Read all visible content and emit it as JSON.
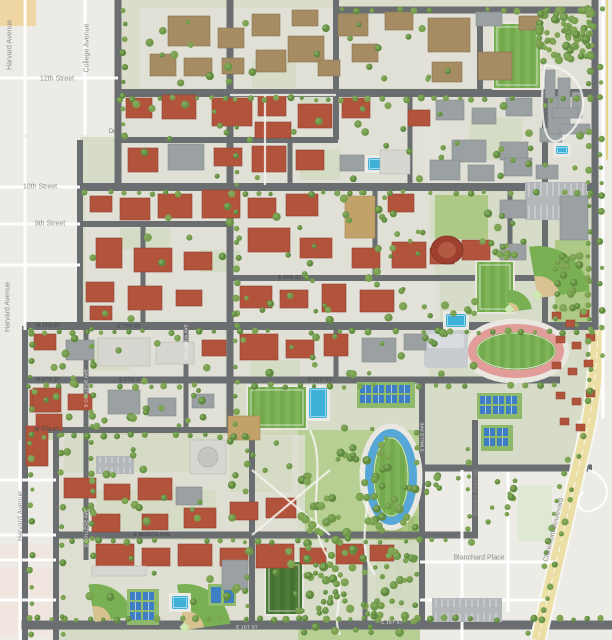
{
  "map": {
    "street_labels": [
      {
        "text": "Harvard Avenue",
        "x": 10,
        "y": 45,
        "rot": -90,
        "cls": "city"
      },
      {
        "text": "College Avenue",
        "x": 87,
        "y": 48,
        "rot": -90,
        "cls": "city"
      },
      {
        "text": "12th Street",
        "x": 57,
        "y": 79,
        "rot": 0,
        "cls": "city"
      },
      {
        "text": "10th Street",
        "x": 40,
        "y": 187,
        "rot": 0,
        "cls": "city"
      },
      {
        "text": "9th Street",
        "x": 50,
        "y": 224,
        "rot": 0,
        "cls": "city"
      },
      {
        "text": "Dr",
        "x": 112,
        "y": 132,
        "rot": 0,
        "cls": "drlbl"
      },
      {
        "text": "Harvard Avenue",
        "x": 8,
        "y": 307,
        "rot": -90,
        "cls": "city"
      },
      {
        "text": "Harvard Avenue",
        "x": 21,
        "y": 516,
        "rot": -90,
        "cls": "city"
      },
      {
        "text": "Brooks Avenue",
        "x": 476,
        "y": 493,
        "rot": -90,
        "cls": "city"
      },
      {
        "text": "Claremont Boulevard",
        "x": 554,
        "y": 530,
        "rot": -76,
        "cls": "city"
      },
      {
        "text": "Blanchard Place",
        "x": 479,
        "y": 558,
        "rot": 0,
        "cls": "city"
      },
      {
        "text": "E BONITA AVE",
        "x": 152,
        "y": 535,
        "rot": 0,
        "cls": "tiny"
      },
      {
        "text": "E 8TH ST",
        "x": 290,
        "y": 278,
        "rot": 0,
        "cls": "tiny"
      },
      {
        "text": "W 7TH ST",
        "x": 48,
        "y": 326,
        "rot": 0,
        "cls": "tiny"
      },
      {
        "text": "E 7TH ST",
        "x": 129,
        "y": 327,
        "rot": 0,
        "cls": "tiny"
      },
      {
        "text": "W 6TH ST",
        "x": 48,
        "y": 380,
        "rot": 0,
        "cls": "tiny"
      },
      {
        "text": "E 6TH ST",
        "x": 131,
        "y": 380,
        "rot": 0,
        "cls": "tiny"
      },
      {
        "text": "E 6TH ST",
        "x": 320,
        "y": 380,
        "rot": 0,
        "cls": "tiny"
      },
      {
        "text": "W 4TH ST",
        "x": 47,
        "y": 430,
        "rot": 0,
        "cls": "tiny"
      },
      {
        "text": "E 1ST ST",
        "x": 247,
        "y": 627,
        "rot": 0,
        "cls": "roadwhite"
      },
      {
        "text": "E 1ST ST",
        "x": 392,
        "y": 622,
        "rot": 0,
        "cls": "roadwhite"
      },
      {
        "text": "S COLLEGE AVE",
        "x": 86,
        "y": 388,
        "rot": -90,
        "cls": "roadwhite"
      },
      {
        "text": "S COLLEGE AVE",
        "x": 86,
        "y": 528,
        "rot": -90,
        "cls": "roadwhite"
      },
      {
        "text": "COLUMBIA AVE",
        "x": 186,
        "y": 342,
        "rot": -90,
        "cls": "roadwhite"
      },
      {
        "text": "S MILLS AVE",
        "x": 422,
        "y": 437,
        "rot": -90,
        "cls": "roadwhite"
      }
    ],
    "colors": {
      "city": "#edebe6",
      "campus": "#d7dcc9",
      "road": "#6b6e71",
      "boulevard": "#ebdfa6",
      "red_roof": "#b2543c",
      "brown_roof": "#a68c63",
      "gray_roof": "#9ba1a3",
      "white_roof": "#d8d6d1",
      "tan_roof": "#c3a26a",
      "round_hall": "#9e3f2f",
      "tree": "#6e9749",
      "tree_light": "#85ad5c",
      "lawn": "#a9c77d",
      "field_a": "#7fb558",
      "field_b": "#74aa4e",
      "field_dark": "#4e7c39",
      "track_pink": "#e29d9a",
      "track_blue": "#56a7d8",
      "pool": "#3fb1d8",
      "tennis": "#3d7ec5",
      "infield_sand": "#d9c291",
      "parking": "#b4b7ba",
      "orange_block": "#eed7a2",
      "pink_block": "#f0e6df",
      "park_block": "#dfe8d4"
    }
  }
}
